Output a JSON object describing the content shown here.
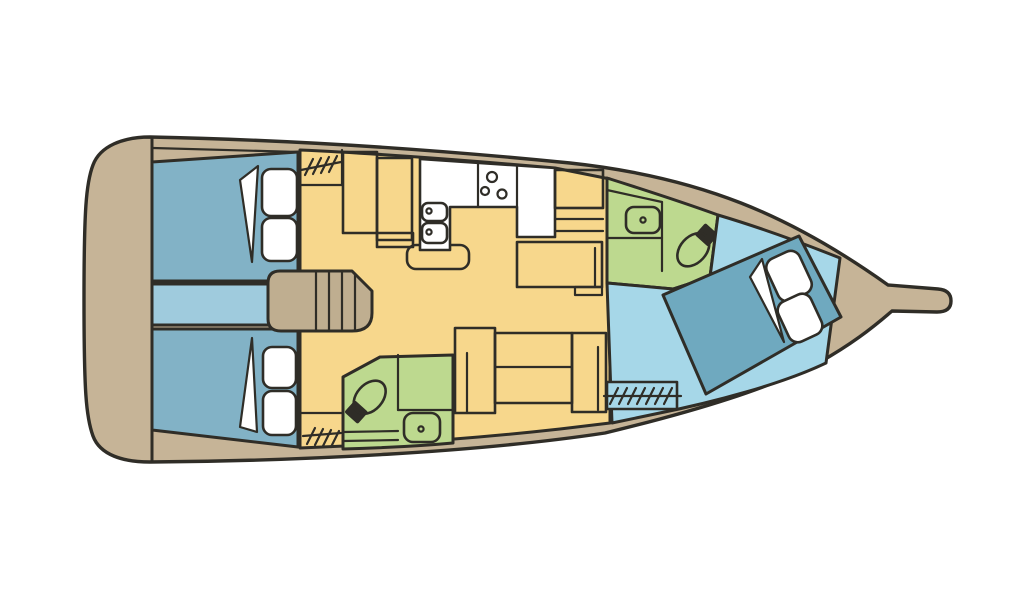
{
  "diagram": {
    "type": "yacht-floor-plan",
    "orientation": "bow-right",
    "colors": {
      "outline": "#2F2D27",
      "hull": "#C6B497",
      "steps": "#BFAE90",
      "salon": "#F7D78C",
      "cabinAft": "#82B2C6",
      "bedFwd": "#6FA9BF",
      "passage": "#9FCBDD",
      "fwdFloor": "#A6D7E8",
      "head": "#BDD98F",
      "fixtureWhite": "#FFFFFF",
      "background": "#FFFFFF"
    },
    "regions": [
      {
        "name": "stern-deck",
        "kind": "deck",
        "fixtures": []
      },
      {
        "name": "aft-cabin-upper",
        "kind": "double-cabin",
        "fixtures": [
          "double-bed",
          "blanket-fold",
          "pillow",
          "pillow"
        ]
      },
      {
        "name": "companionway",
        "kind": "passage",
        "fixtures": [
          "entry-steps"
        ]
      },
      {
        "name": "aft-cabin-lower",
        "kind": "double-cabin",
        "fixtures": [
          "double-bed",
          "blanket-fold",
          "pillow",
          "pillow"
        ]
      },
      {
        "name": "salon",
        "kind": "main-cabin",
        "fixtures": [
          "galley-counter",
          "double-sink",
          "stove-burners",
          "nav-cabinets",
          "round-table",
          "shelf-cabinet",
          "side-seat",
          "dinette-settee",
          "door-hatch",
          "door-hatch"
        ]
      },
      {
        "name": "head-upper",
        "kind": "bathroom",
        "fixtures": [
          "washbasin",
          "toilet"
        ]
      },
      {
        "name": "head-lower",
        "kind": "bathroom",
        "fixtures": [
          "washbasin",
          "toilet",
          "shower-grate"
        ]
      },
      {
        "name": "forward-cabin",
        "kind": "double-cabin",
        "fixtures": [
          "angled-double-bed",
          "blanket-fold",
          "pillow",
          "pillow",
          "entry-hatch"
        ]
      },
      {
        "name": "bow-deck",
        "kind": "deck",
        "fixtures": [
          "bowsprit"
        ]
      }
    ]
  }
}
